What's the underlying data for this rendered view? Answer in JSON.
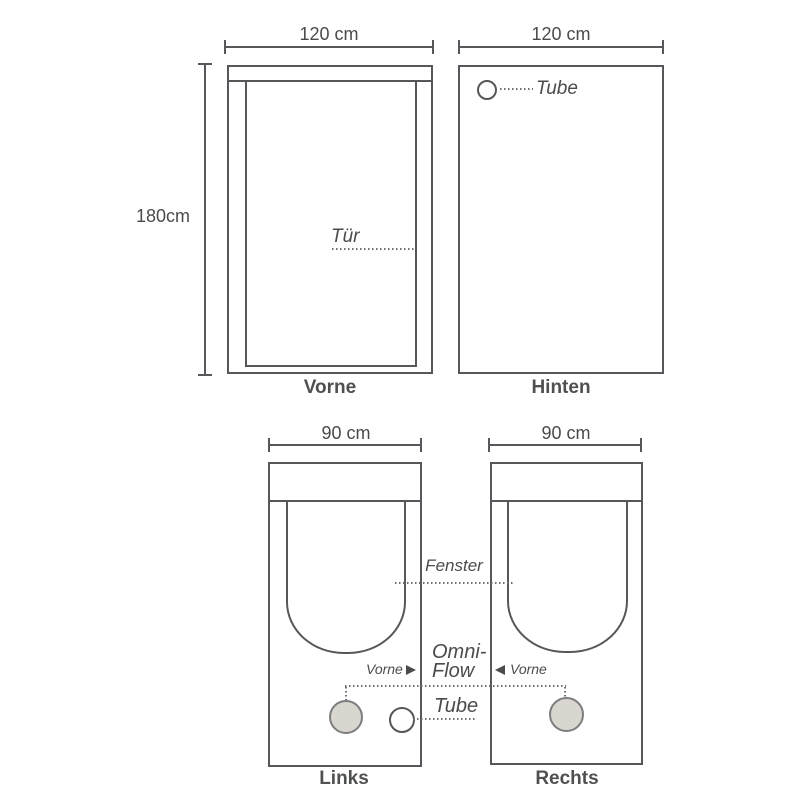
{
  "colors": {
    "line": "#56575a",
    "text": "#4a4b4d",
    "caption": "#4f5052",
    "dotted_line": "#6e6e70",
    "vent_fill": "#d9d6d0",
    "vent_border": "#7d7d7f",
    "background": "#ffffff"
  },
  "front_view": {
    "width_label": "120 cm",
    "height_label": "180cm",
    "door_label": "Tür",
    "caption": "Vorne"
  },
  "back_view": {
    "width_label": "120 cm",
    "tube_label": "Tube",
    "caption": "Hinten"
  },
  "left_view": {
    "width_label": "90 cm",
    "caption": "Links"
  },
  "right_view": {
    "width_label": "90 cm",
    "caption": "Rechts"
  },
  "shared_annotations": {
    "window_label": "Fenster",
    "omniflow_line1": "Omni-",
    "omniflow_line2": "Flow",
    "tube_label": "Tube",
    "direction_label_left": "Vorne",
    "direction_label_right": "Vorne"
  }
}
